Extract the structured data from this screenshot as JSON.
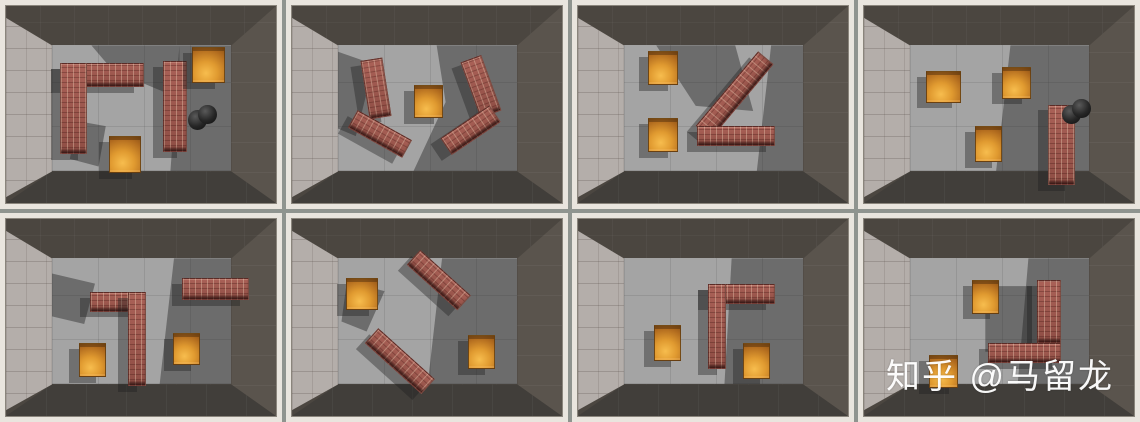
{
  "watermark": {
    "text": "知乎 @马留龙",
    "color": "#ffffff"
  },
  "palette": {
    "frame": "#e9e5de",
    "divider": "#8f948f",
    "wall_top": "#4b4640",
    "wall_right": "#5a544d",
    "wall_bottom": "#413e3a",
    "wall_left_tiles": "#b4aeaa",
    "floor": "#a4a4a4",
    "shadow": "rgba(30,30,30,0.42)",
    "brick_wall": "#9d574d",
    "crate_orange": "#e09a30",
    "sphere_black": "#1a1a1a"
  },
  "grid": {
    "rows": 2,
    "cols": 4
  },
  "panels": [
    {
      "floor_shadows": [
        "polygon(71% 0%, 100% 0%, 100% 100%, 66% 100%)",
        "polygon(22% 0%, 71% 0%, 71% 42%, 34% 20%)",
        "polygon(14% 60%, 30% 64%, 26% 96%, 10% 90%)"
      ],
      "objects": [
        {
          "type": "brick",
          "x": 20,
          "y": 29,
          "w": 31,
          "h": 12,
          "rot": 0
        },
        {
          "type": "brick",
          "x": 20,
          "y": 29,
          "w": 10,
          "h": 46,
          "rot": 0
        },
        {
          "type": "brick",
          "x": 58,
          "y": 28,
          "w": 9,
          "h": 46,
          "rot": 0
        },
        {
          "type": "box",
          "x": 69,
          "y": 21,
          "w": 12,
          "h": 18,
          "rot": 0
        },
        {
          "type": "sphere",
          "x": 71,
          "y": 50,
          "w": 7,
          "h": 10,
          "rot": 0
        },
        {
          "type": "box",
          "x": 38,
          "y": 66,
          "w": 12,
          "h": 19,
          "rot": 0
        }
      ]
    },
    {
      "floor_shadows": [
        "polygon(55% 0%, 100% 0%, 100% 100%, 42% 100%, 60% 45%)",
        "polygon(0% 5%, 20% 15%, 10% 72%, 0% 66%)"
      ],
      "objects": [
        {
          "type": "brick",
          "x": 27,
          "y": 27,
          "w": 8,
          "h": 30,
          "rot": -9
        },
        {
          "type": "brick",
          "x": 21,
          "y": 60,
          "w": 23,
          "h": 10,
          "rot": 29
        },
        {
          "type": "brick",
          "x": 66,
          "y": 26,
          "w": 8,
          "h": 30,
          "rot": -20
        },
        {
          "type": "brick",
          "x": 55,
          "y": 58,
          "w": 22,
          "h": 10,
          "rot": -34
        },
        {
          "type": "box",
          "x": 45,
          "y": 40,
          "w": 11,
          "h": 17,
          "rot": 0
        }
      ]
    },
    {
      "floor_shadows": [
        "polygon(18% 0%, 62% 0%, 72% 52%, 40% 48%)",
        "polygon(82% 0%, 100% 0%, 100% 100%, 74% 100%)"
      ],
      "objects": [
        {
          "type": "brick",
          "x": 40,
          "y": 40,
          "w": 36,
          "h": 10,
          "rot": -50
        },
        {
          "type": "brick",
          "x": 44,
          "y": 61,
          "w": 29,
          "h": 10,
          "rot": 0
        },
        {
          "type": "box",
          "x": 26,
          "y": 23,
          "w": 11,
          "h": 17,
          "rot": 0
        },
        {
          "type": "box",
          "x": 26,
          "y": 57,
          "w": 11,
          "h": 17,
          "rot": 0
        }
      ]
    },
    {
      "floor_shadows": [
        "polygon(56% 0%, 100% 0%, 100% 100%, 48% 100%)"
      ],
      "objects": [
        {
          "type": "box",
          "x": 23,
          "y": 33,
          "w": 13,
          "h": 16,
          "rot": 0
        },
        {
          "type": "box",
          "x": 51,
          "y": 31,
          "w": 11,
          "h": 16,
          "rot": 0
        },
        {
          "type": "box",
          "x": 41,
          "y": 61,
          "w": 10,
          "h": 18,
          "rot": 0
        },
        {
          "type": "brick",
          "x": 68,
          "y": 50,
          "w": 10,
          "h": 41,
          "rot": 0
        },
        {
          "type": "sphere",
          "x": 77,
          "y": 47,
          "w": 7,
          "h": 10,
          "rot": 0
        }
      ]
    },
    {
      "floor_shadows": [
        "polygon(68% 0%, 100% 0%, 100% 100%, 60% 100%)",
        "polygon(0% 12%, 24% 20%, 18% 52%, 0% 46%)"
      ],
      "objects": [
        {
          "type": "brick",
          "x": 31,
          "y": 37,
          "w": 20,
          "h": 10,
          "rot": 0
        },
        {
          "type": "brick",
          "x": 45,
          "y": 37,
          "w": 7,
          "h": 48,
          "rot": 0
        },
        {
          "type": "brick",
          "x": 65,
          "y": 30,
          "w": 25,
          "h": 11,
          "rot": 0
        },
        {
          "type": "box",
          "x": 27,
          "y": 63,
          "w": 10,
          "h": 17,
          "rot": 0
        },
        {
          "type": "box",
          "x": 62,
          "y": 58,
          "w": 10,
          "h": 16,
          "rot": 0
        }
      ]
    },
    {
      "floor_shadows": [
        "polygon(58% 0%, 100% 0%, 100% 100%, 50% 100%)",
        "polygon(5% 18%, 26% 26%, 16% 58%, 2% 50%)"
      ],
      "objects": [
        {
          "type": "brick",
          "x": 42,
          "y": 26,
          "w": 25,
          "h": 10,
          "rot": 42
        },
        {
          "type": "brick",
          "x": 26,
          "y": 67,
          "w": 28,
          "h": 10,
          "rot": 42
        },
        {
          "type": "box",
          "x": 20,
          "y": 30,
          "w": 12,
          "h": 16,
          "rot": 0
        },
        {
          "type": "box",
          "x": 65,
          "y": 59,
          "w": 10,
          "h": 17,
          "rot": 0
        }
      ]
    },
    {
      "floor_shadows": [
        "polygon(60% 0%, 100% 0%, 100% 100%, 56% 100%)"
      ],
      "objects": [
        {
          "type": "brick",
          "x": 48,
          "y": 33,
          "w": 25,
          "h": 10,
          "rot": 0
        },
        {
          "type": "brick",
          "x": 48,
          "y": 33,
          "w": 7,
          "h": 43,
          "rot": 0
        },
        {
          "type": "box",
          "x": 28,
          "y": 54,
          "w": 10,
          "h": 18,
          "rot": 0
        },
        {
          "type": "box",
          "x": 61,
          "y": 63,
          "w": 10,
          "h": 18,
          "rot": 0
        }
      ]
    },
    {
      "floor_shadows": [
        "polygon(66% 0%, 100% 0%, 100% 100%, 60% 100%)",
        "polygon(42% 22%, 68% 22%, 68% 74%, 42% 74%)"
      ],
      "objects": [
        {
          "type": "brick",
          "x": 64,
          "y": 31,
          "w": 9,
          "h": 32,
          "rot": 0
        },
        {
          "type": "brick",
          "x": 46,
          "y": 63,
          "w": 27,
          "h": 10,
          "rot": 0
        },
        {
          "type": "box",
          "x": 40,
          "y": 31,
          "w": 10,
          "h": 17,
          "rot": 0
        },
        {
          "type": "box",
          "x": 24,
          "y": 69,
          "w": 11,
          "h": 17,
          "rot": 0
        }
      ]
    }
  ]
}
